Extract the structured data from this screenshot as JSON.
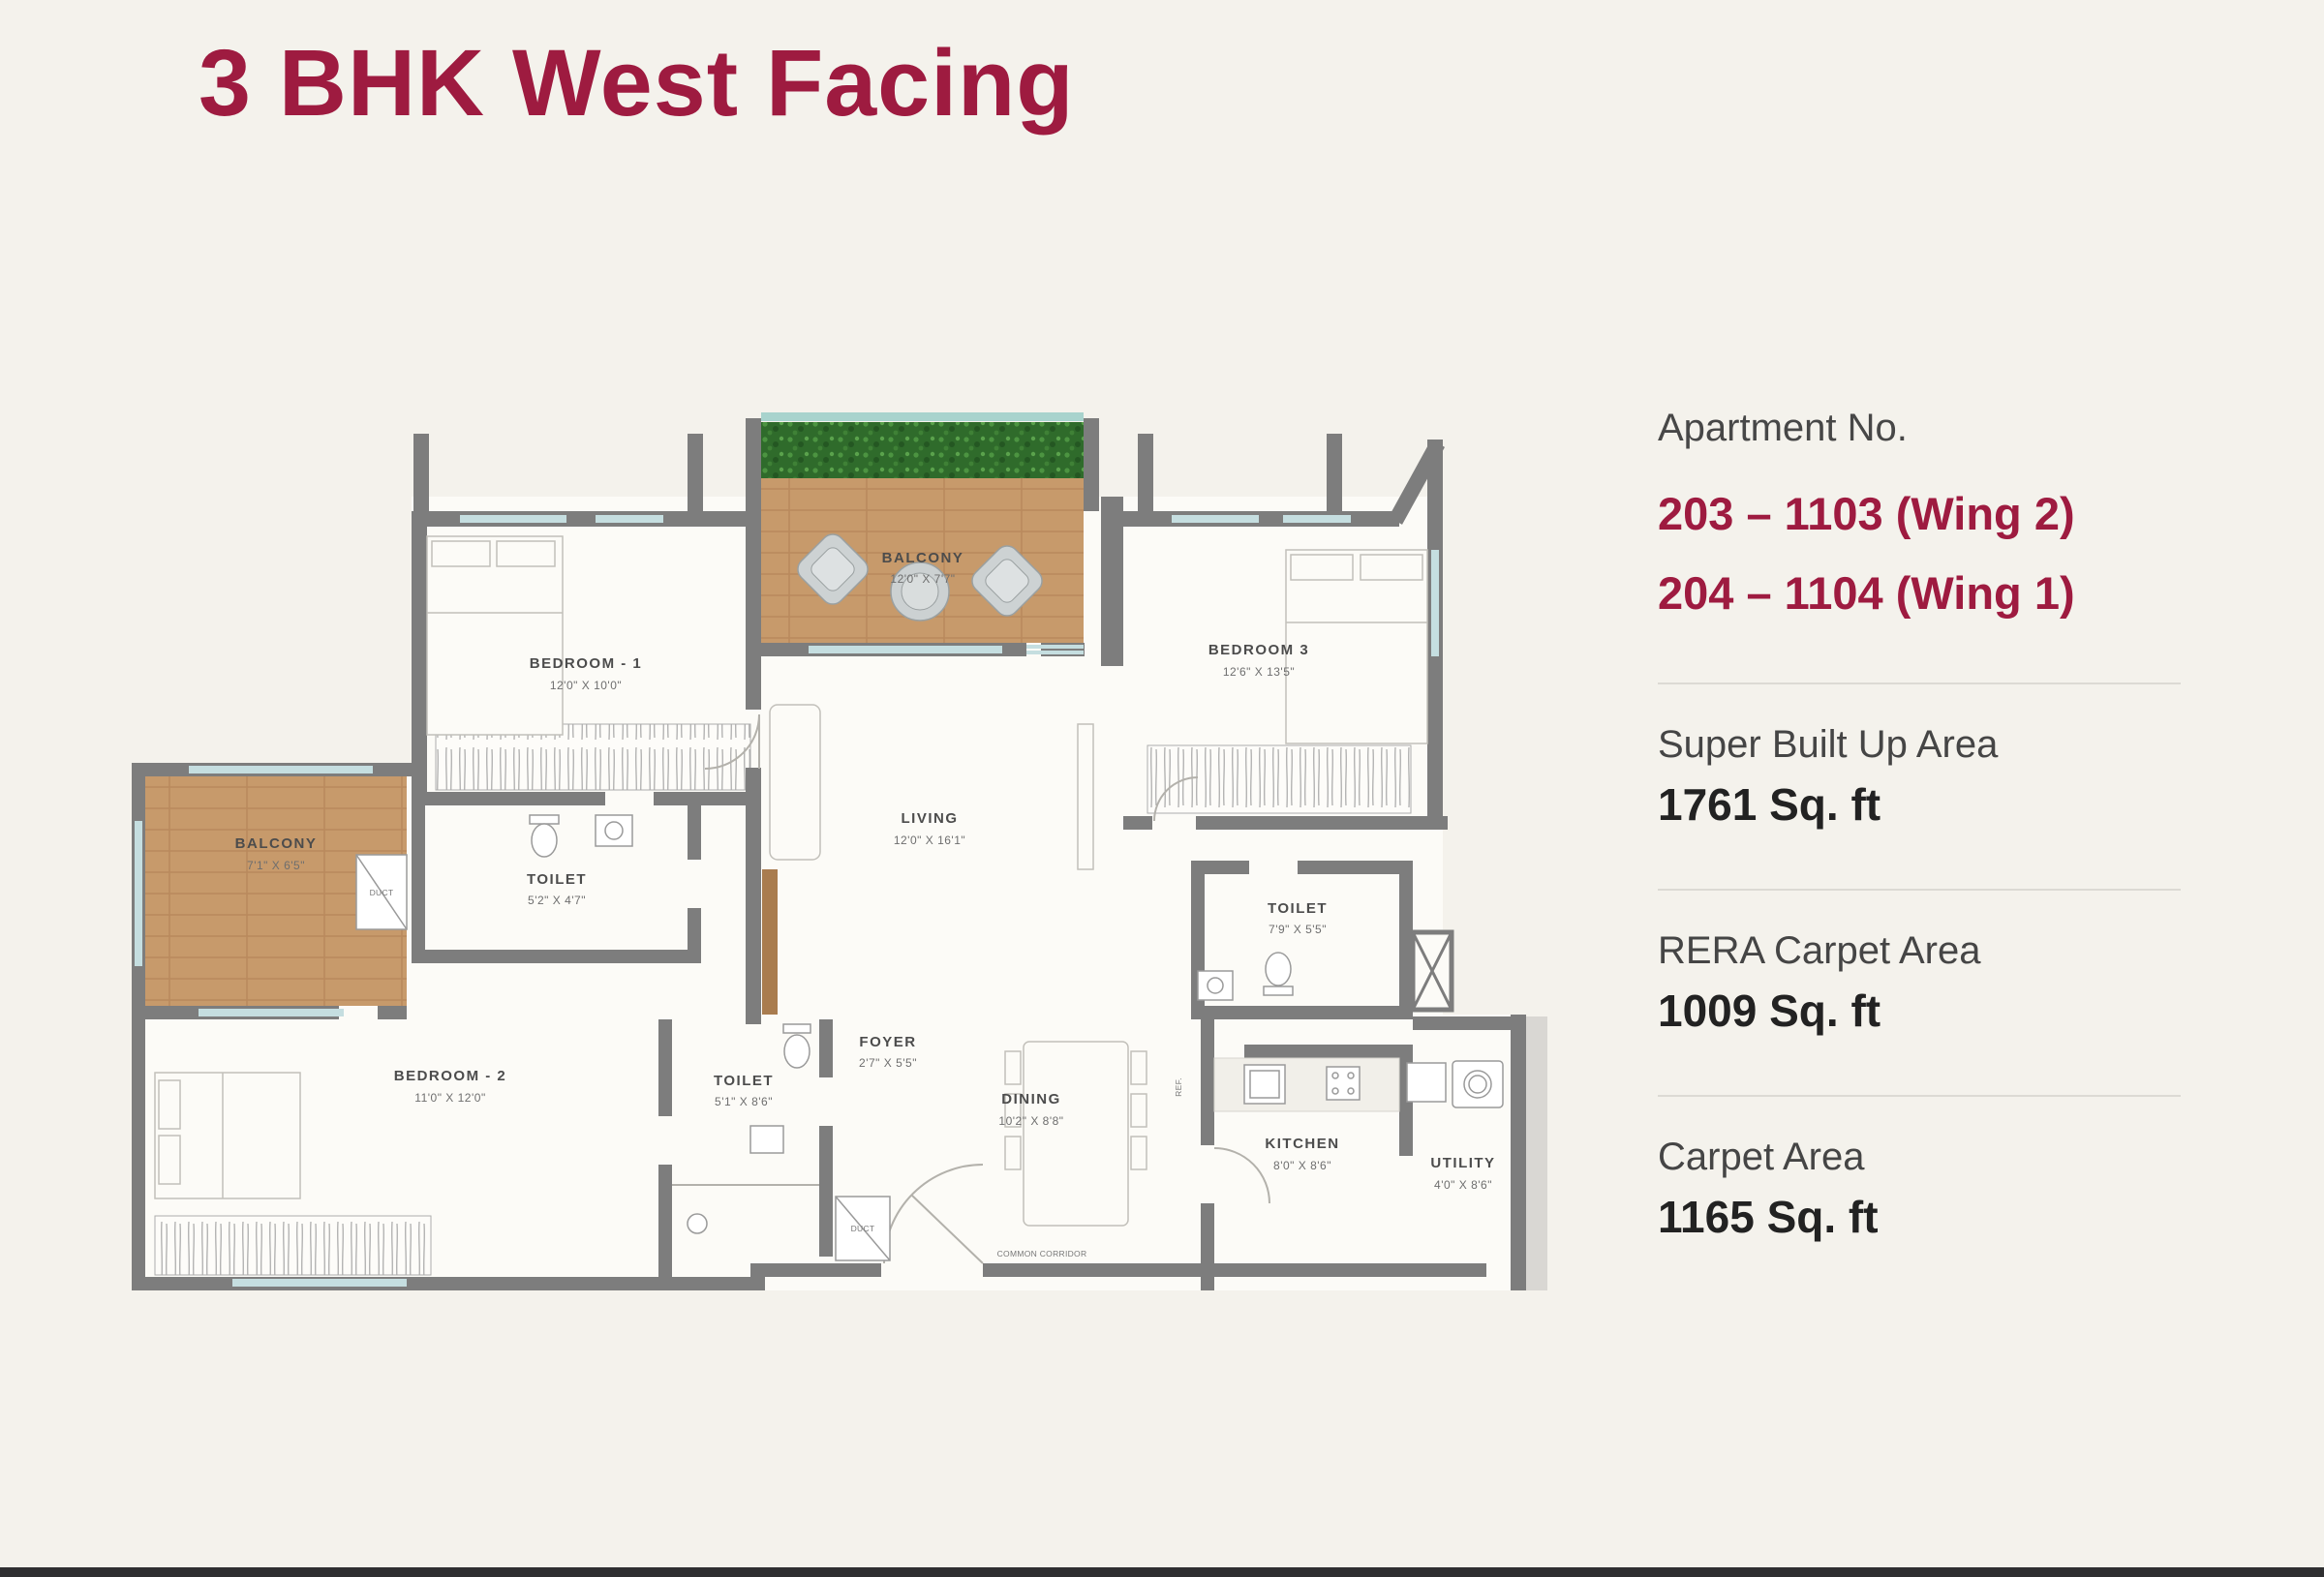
{
  "title": "3 BHK West Facing",
  "theme": {
    "accent": "#9e1b40",
    "background": "#f4f2ec",
    "wall_gray": "#7d7d7d",
    "wood": "#c79a6b",
    "hedge_green": "#2f6b2b"
  },
  "info_panel": {
    "apartment_label": "Apartment No.",
    "apartments": [
      "203 – 1103 (Wing 2)",
      "204 – 1104 (Wing 1)"
    ],
    "areas": [
      {
        "label": "Super Built Up Area",
        "value": "1761 Sq. ft"
      },
      {
        "label": "RERA Carpet Area",
        "value": "1009 Sq. ft"
      },
      {
        "label": "Carpet Area",
        "value": "1165 Sq. ft"
      }
    ]
  },
  "floor_plan": {
    "rooms": {
      "bedroom1": {
        "name": "BEDROOM - 1",
        "dims": "12'0\" X 10'0\""
      },
      "balcony_top": {
        "name": "BALCONY",
        "dims": "12'0\" X 7'7\""
      },
      "bedroom3": {
        "name": "BEDROOM 3",
        "dims": "12'6\" X 13'5\""
      },
      "living": {
        "name": "LIVING",
        "dims": "12'0\" X 16'1\""
      },
      "balcony_left": {
        "name": "BALCONY",
        "dims": "7'1\" X 6'5\""
      },
      "toilet1": {
        "name": "TOILET",
        "dims": "5'2\" X 4'7\""
      },
      "bedroom2": {
        "name": "BEDROOM - 2",
        "dims": "11'0\" X 12'0\""
      },
      "toilet2": {
        "name": "TOILET",
        "dims": "5'1\" X 8'6\""
      },
      "toilet3": {
        "name": "TOILET",
        "dims": "7'9\" X 5'5\""
      },
      "foyer": {
        "name": "FOYER",
        "dims": "2'7\" X 5'5\""
      },
      "dining": {
        "name": "DINING",
        "dims": "10'2\" X 8'8\""
      },
      "kitchen": {
        "name": "KITCHEN",
        "dims": "8'0\" X 8'6\""
      },
      "utility": {
        "name": "UTILITY",
        "dims": "4'0\" X 8'6\""
      },
      "duct_balcony": {
        "name": "DUCT"
      },
      "duct_entry": {
        "name": "DUCT"
      },
      "fridge": {
        "name": "REF."
      },
      "corridor": {
        "name": "COMMON CORRIDOR"
      }
    }
  }
}
